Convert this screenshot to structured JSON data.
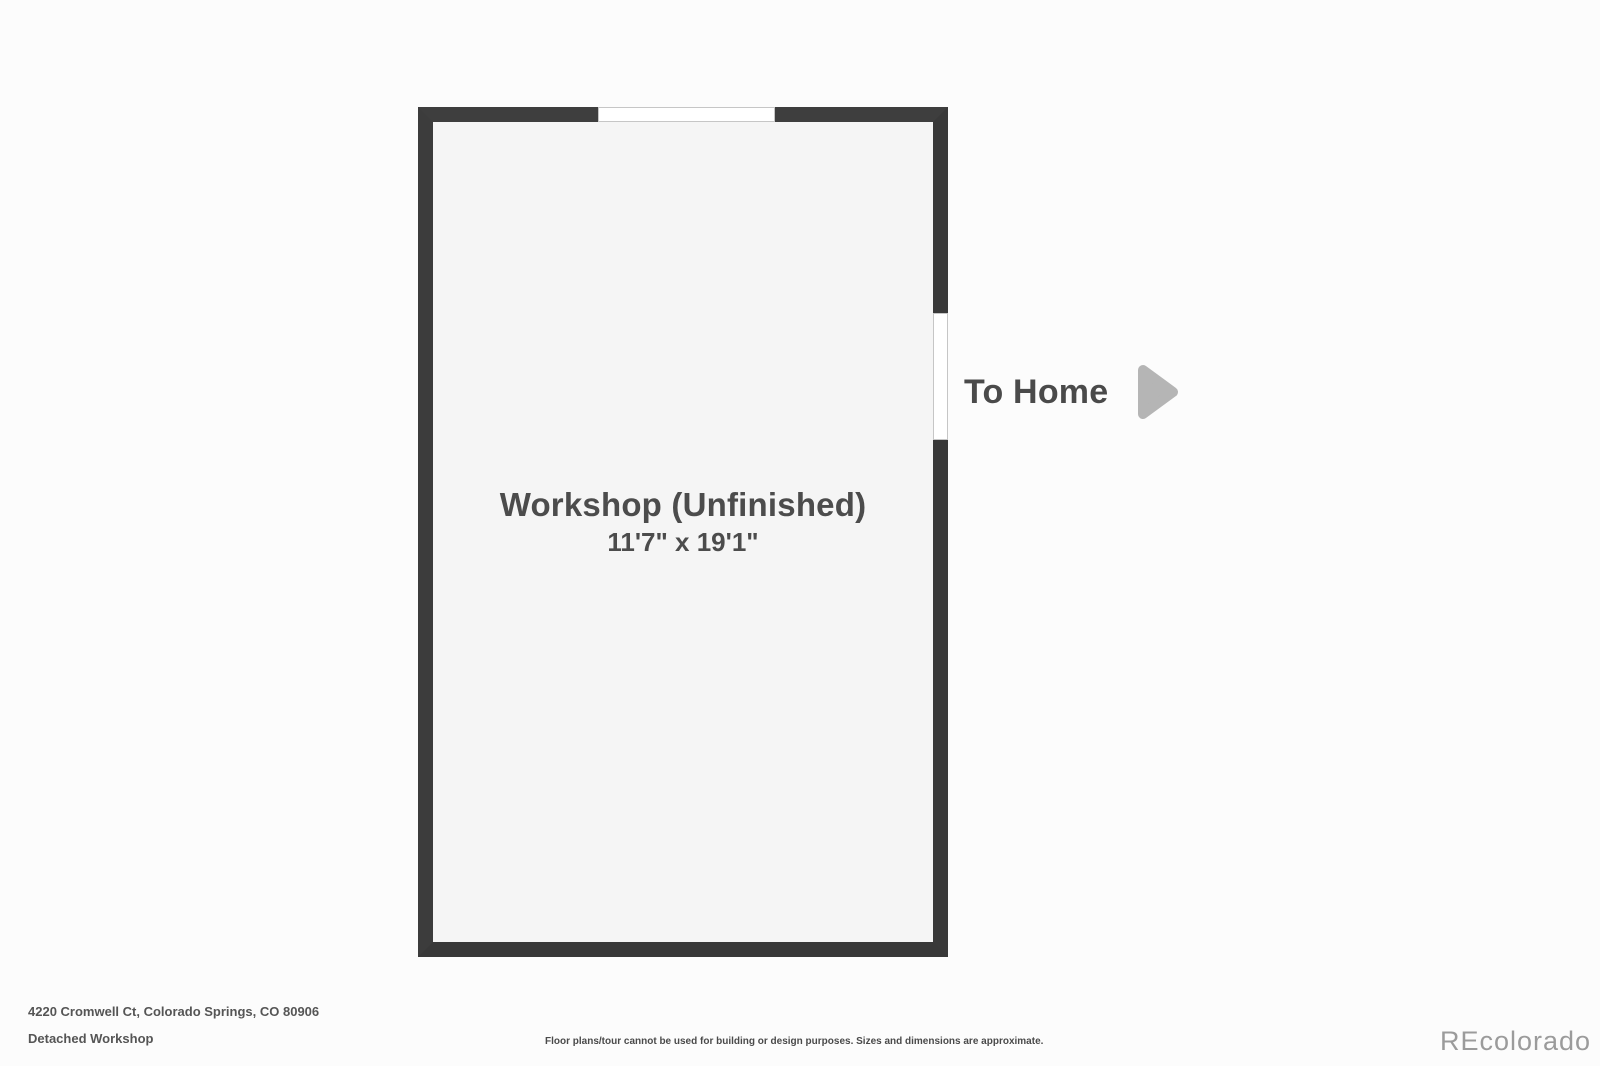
{
  "floorplan": {
    "room": {
      "name": "Workshop (Unfinished)",
      "dimensions": "11'7\" x 19'1\""
    },
    "to_home": {
      "label": "To Home",
      "arrow_icon": "right-arrow-triangle"
    },
    "openings": {
      "top_wall": "window-opening",
      "right_wall": "doorway-to-home"
    }
  },
  "footer": {
    "address": "4220 Cromwell Ct, Colorado Springs, CO 80906",
    "plan_name": "Detached Workshop",
    "disclaimer": "Floor plans/tour cannot be used for building or design purposes. Sizes and dimensions are approximate.",
    "watermark": "REcolorado"
  },
  "colors": {
    "wall": "#3b3b3b",
    "floor": "#f5f5f5",
    "background": "#fcfcfc",
    "label_text": "#4c4c4c",
    "arrow": "#b5b5b5",
    "opening_border": "#c6c6c6",
    "watermark": "#9b9b9b"
  }
}
